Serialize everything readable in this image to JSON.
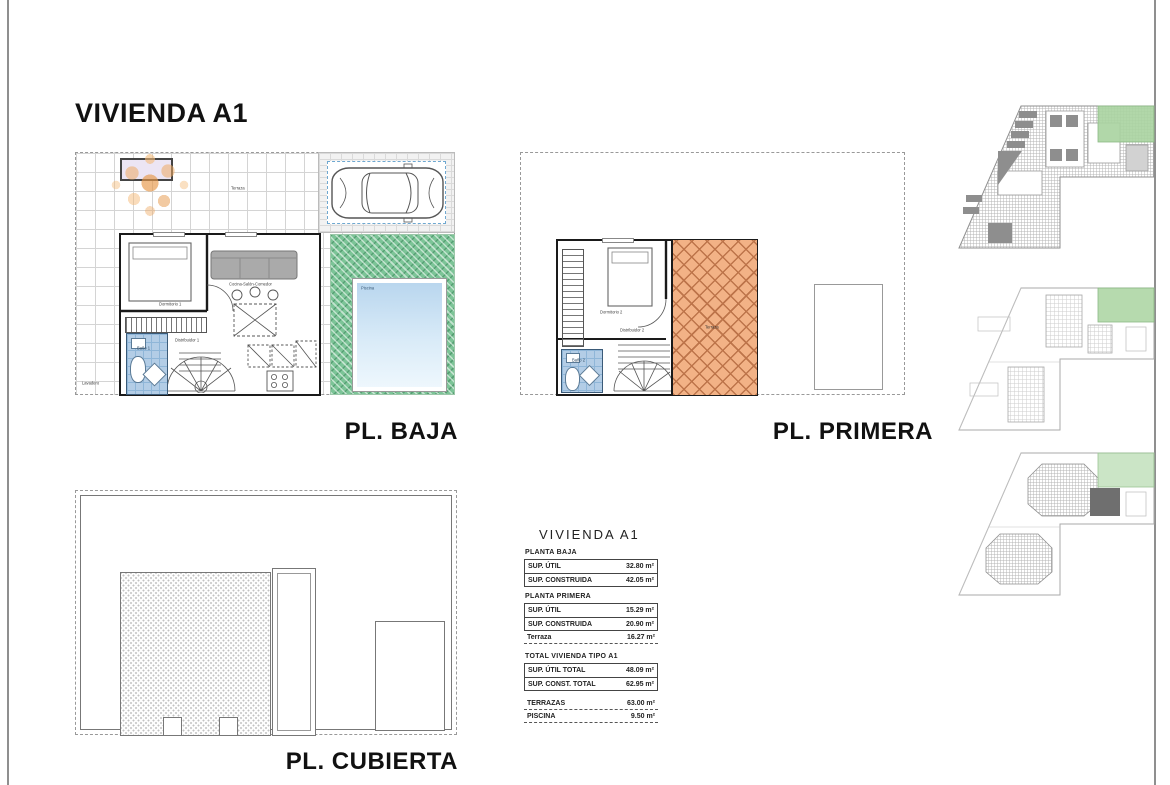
{
  "page": {
    "title": "VIVIENDA A1"
  },
  "plans": {
    "baja": {
      "label": "PL. BAJA",
      "rooms": {
        "terraza": "Terraza",
        "dormitorio": "Dormitorio 1",
        "salon": "Cocina-Salón-Comedor",
        "distribuidor": "Distribuidor 1",
        "bano": "Baño 1",
        "lavadero": "Lavadero",
        "piscina": "Piscina"
      }
    },
    "primera": {
      "label": "PL. PRIMERA",
      "rooms": {
        "dormitorio": "Dormitorio 2",
        "distribuidor": "Distribuidor 2",
        "bano": "Baño 2",
        "terraza": "Terraza"
      }
    },
    "cubierta": {
      "label": "PL. CUBIERTA"
    }
  },
  "summary_table": {
    "title": "VIVIENDA A1",
    "sections": [
      {
        "heading": "PLANTA BAJA",
        "rows": [
          {
            "label": "SUP. ÚTIL",
            "value": "32.80 m²"
          },
          {
            "label": "SUP. CONSTRUIDA",
            "value": "42.05 m²"
          }
        ]
      },
      {
        "heading": "PLANTA PRIMERA",
        "rows": [
          {
            "label": "SUP. ÚTIL",
            "value": "15.29 m²"
          },
          {
            "label": "SUP. CONSTRUIDA",
            "value": "20.90 m²"
          }
        ],
        "loose_rows": [
          {
            "label": "Terraza",
            "value": "16.27 m²"
          }
        ]
      },
      {
        "heading": "TOTAL VIVIENDA TIPO A1",
        "rows": [
          {
            "label": "SUP. ÚTIL TOTAL",
            "value": "48.09 m²"
          },
          {
            "label": "SUP. CONST. TOTAL",
            "value": "62.95 m²"
          }
        ]
      }
    ],
    "footer_rows": [
      {
        "label": "TERRAZAS",
        "value": "63.00 m²"
      },
      {
        "label": "PISCINA",
        "value": "9.50 m²"
      }
    ]
  },
  "colors": {
    "highlight_green": "#a9d3a0",
    "terrace_orange": "#f2b286",
    "pool_blue": "#b9d6ee",
    "bath_blue": "#b3cde6",
    "grass_green": "#7cc497"
  }
}
